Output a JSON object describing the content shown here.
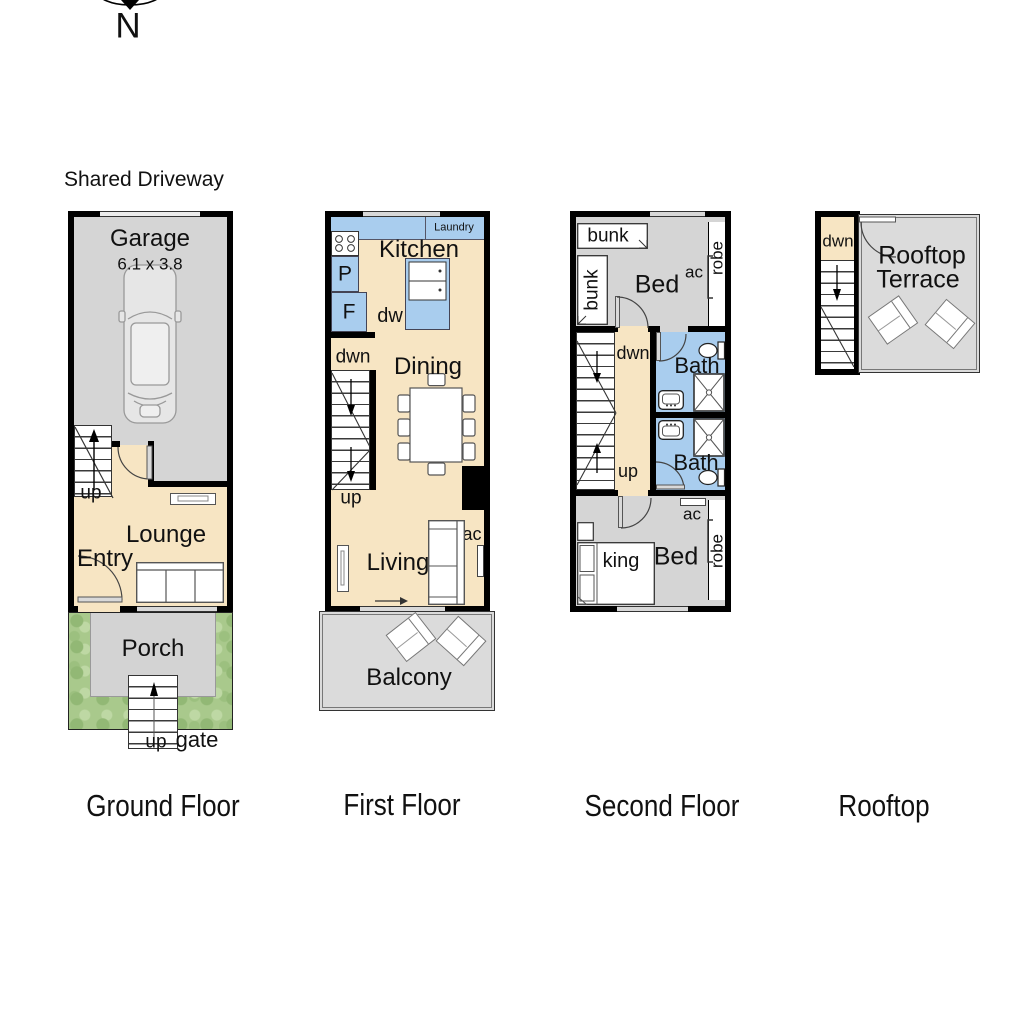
{
  "compass": {
    "n": "N"
  },
  "driveway": {
    "label": "Shared Driveway"
  },
  "colors": {
    "wall": "#000000",
    "interior_cream": "#F7E5C3",
    "wet_area_blue": "#A9CDEE",
    "room_gray": "#D5D5D5",
    "outdoor_gray": "#DBDBDB",
    "garden_green": "#A9C98C"
  },
  "ground": {
    "title": "Ground Floor",
    "garage": "Garage",
    "garage_dim": "6.1 x 3.8",
    "up": "up",
    "lounge": "Lounge",
    "entry": "Entry",
    "porch": "Porch",
    "steps_up": "up",
    "gate": "gate"
  },
  "first": {
    "title": "First Floor",
    "laundry": "Laundry",
    "kitchen": "Kitchen",
    "pantry": "P",
    "fridge": "F",
    "dw": "dw",
    "dwn": "dwn",
    "dining": "Dining",
    "up": "up",
    "ac": "ac",
    "living": "Living",
    "balcony": "Balcony"
  },
  "second": {
    "title": "Second Floor",
    "bunk_a": "bunk",
    "bunk_b": "bunk",
    "bed_top": "Bed",
    "ac_top": "ac",
    "robe_top": "robe",
    "dwn": "dwn",
    "bath_top": "Bath",
    "up": "up",
    "bath_bottom": "Bath",
    "ac_bottom": "ac",
    "bed_bottom": "Bed",
    "king": "king",
    "robe_bottom": "robe"
  },
  "rooftop": {
    "title": "Rooftop",
    "dwn": "dwn",
    "name_line1": "Rooftop",
    "name_line2": "Terrace"
  }
}
